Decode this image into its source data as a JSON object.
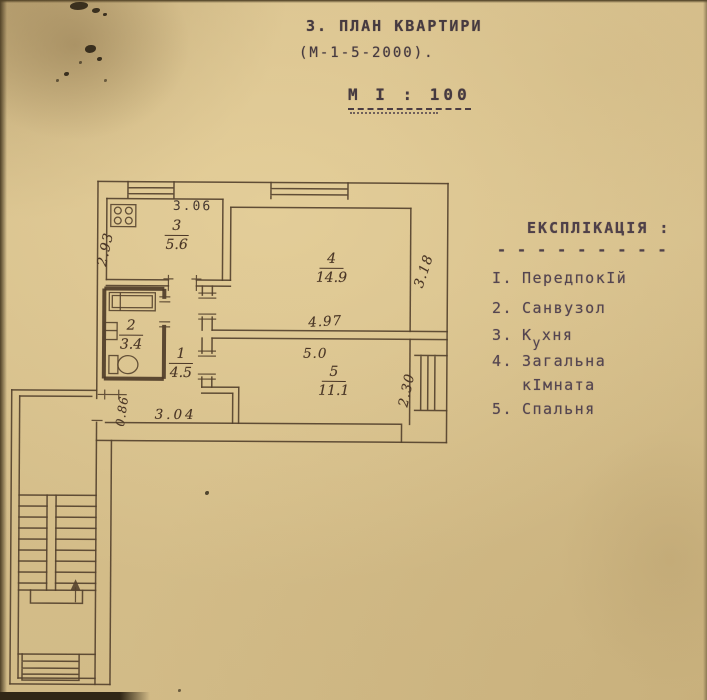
{
  "header": {
    "title": "3. ПЛАН КВАРТИРИ",
    "series": "(М-1-5-2000).",
    "scale": "М І : 100"
  },
  "legend": {
    "title": "ЕКСПЛІКАЦІЯ :",
    "divider": "- - - - - - - - -",
    "items": [
      {
        "num": "І.",
        "label": "ПередпокІй"
      },
      {
        "num": "2.",
        "label": "Санвузол"
      },
      {
        "num": "3.",
        "pre": "К",
        "sub": "у",
        "post": "хня"
      },
      {
        "num": "4.",
        "label": "Загальна",
        "label2": "кІмната"
      },
      {
        "num": "5.",
        "label": "Спальня"
      }
    ]
  },
  "plan": {
    "rooms": [
      {
        "name": "kitchen",
        "num": "3",
        "area": "5.6"
      },
      {
        "name": "living",
        "num": "4",
        "area": "14.9"
      },
      {
        "name": "bathroom",
        "num": "2",
        "area": "3.4"
      },
      {
        "name": "hallway",
        "num": "1",
        "area": "4.5"
      },
      {
        "name": "bedroom",
        "num": "5",
        "area": "11.1"
      }
    ],
    "dims": {
      "kitchen_width": "3.06",
      "kitchen_depth": "2.93",
      "living_depth": "3.18",
      "living_width": "4.97",
      "bedroom_width": "5.0",
      "bedroom_depth": "2.30",
      "hall_width": "3.04",
      "entry_width": "0.86"
    }
  }
}
